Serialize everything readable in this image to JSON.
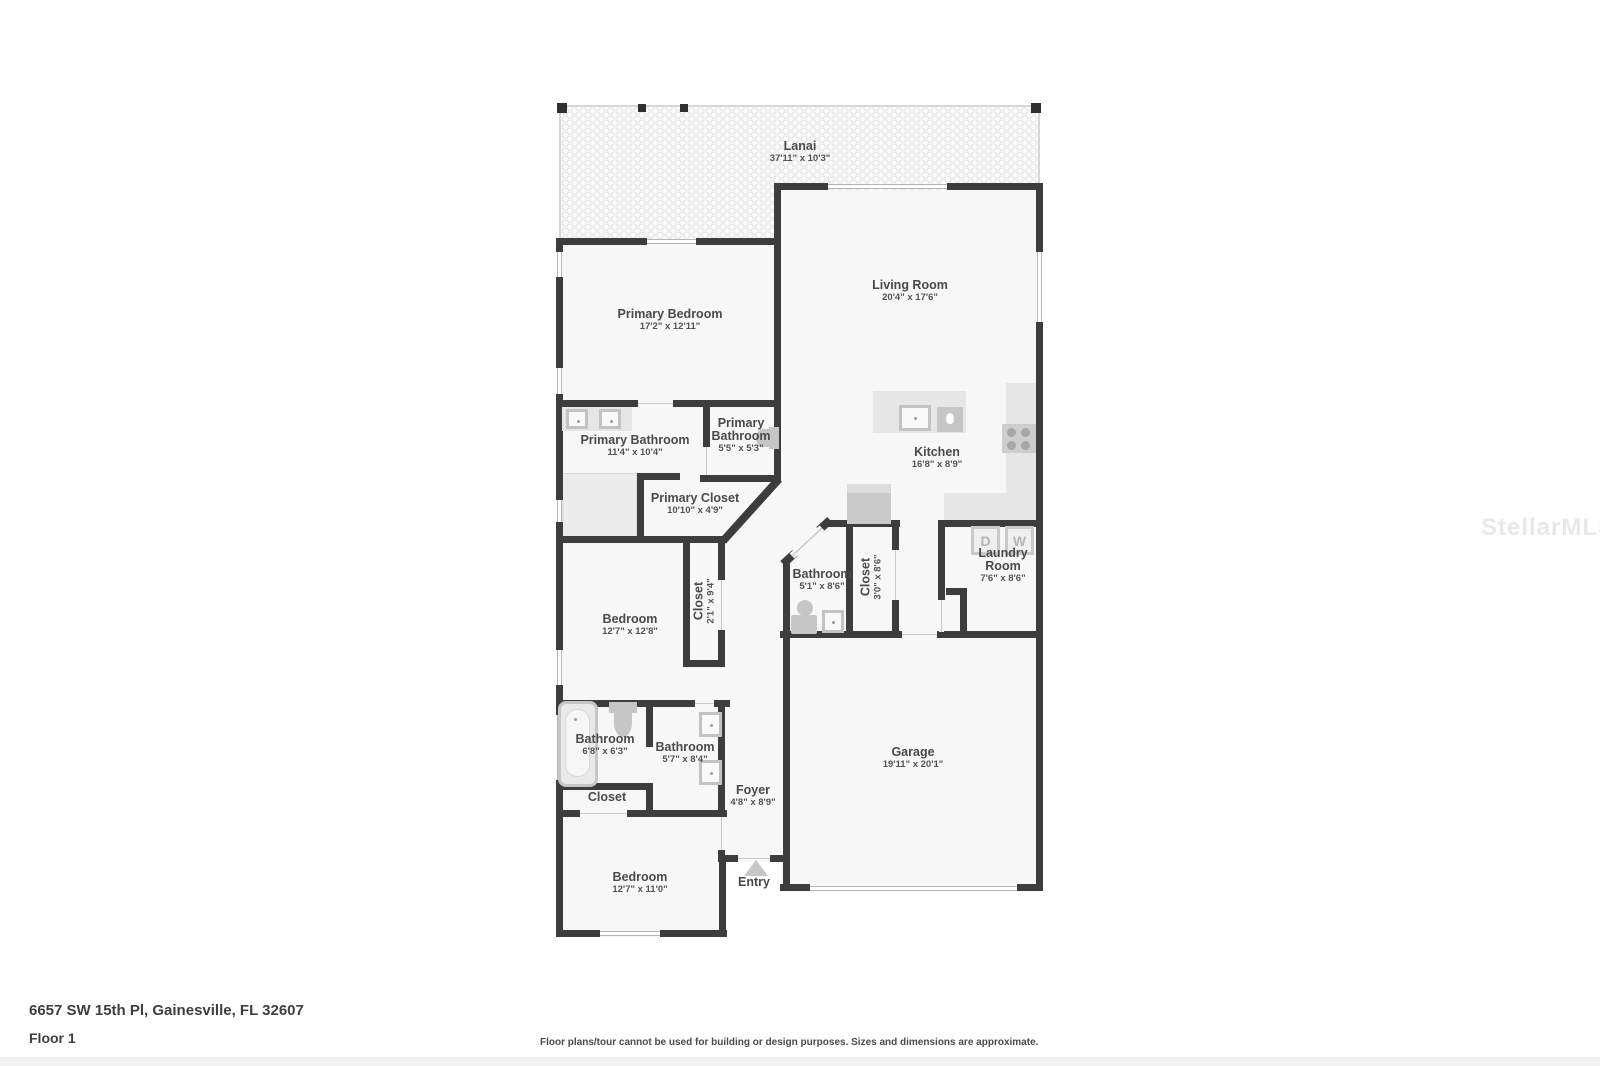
{
  "page": {
    "address": "6657 SW 15th Pl, Gainesville, FL 32607",
    "floor_label": "Floor 1",
    "disclaimer": "Floor plans/tour cannot be used for building or design purposes. Sizes and dimensions are approximate.",
    "watermark": "StellarMLS"
  },
  "appliances": {
    "dryer": "D",
    "washer": "W"
  },
  "rooms": [
    {
      "name": "Lanai",
      "dims": "37'11\" x 10'3\""
    },
    {
      "name": "Living Room",
      "dims": "20'4\" x 17'6\""
    },
    {
      "name": "Primary Bedroom",
      "dims": "17'2\" x 12'11\""
    },
    {
      "name": "Primary Bathroom",
      "dims": "11'4\" x 10'4\""
    },
    {
      "name": "Primary Bathroom",
      "dims": "5'5\" x 5'3\""
    },
    {
      "name": "Kitchen",
      "dims": "16'8\" x 8'9\""
    },
    {
      "name": "Primary Closet",
      "dims": "10'10\" x 4'9\""
    },
    {
      "name": "Bathroom",
      "dims": "5'1\" x 8'6\""
    },
    {
      "name": "Closet",
      "dims": "3'0\" x 8'6\""
    },
    {
      "name": "Laundry Room",
      "dims": "7'6\" x 8'6\""
    },
    {
      "name": "Bedroom",
      "dims": "12'7\" x 12'8\""
    },
    {
      "name": "Closet",
      "dims": "2'1\" x 9'4\""
    },
    {
      "name": "Bathroom",
      "dims": "6'8\" x 6'3\""
    },
    {
      "name": "Bathroom",
      "dims": "5'7\" x 8'4\""
    },
    {
      "name": "Closet",
      "dims": ""
    },
    {
      "name": "Foyer",
      "dims": "4'8\" x 8'9\""
    },
    {
      "name": "Garage",
      "dims": "19'11\" x 20'1\""
    },
    {
      "name": "Bedroom",
      "dims": "12'7\" x 11'0\""
    },
    {
      "name": "Entry",
      "dims": ""
    }
  ],
  "colors": {
    "wall": "#3d3d3d",
    "room_fill": "#f7f7f7",
    "fixture": "#c6c6c6",
    "counter": "#e6e6e6",
    "label_text": "#4a4a4a"
  }
}
